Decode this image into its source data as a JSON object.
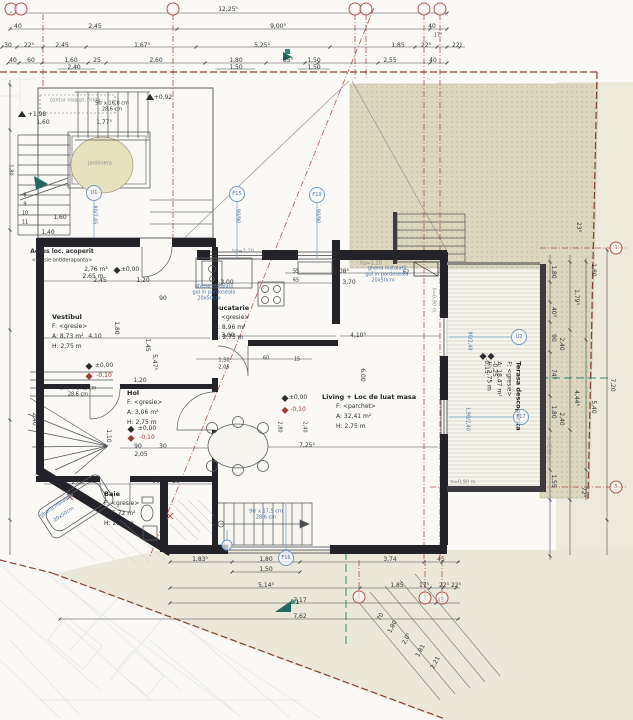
{
  "drawing": {
    "type": "architectural floor plan",
    "bubble_color": "#b5534b",
    "tag_color": "#4c74a8",
    "garden_color": "#dcd8bf",
    "paper_color": "#faf9f5",
    "pale_color": "#ebe8d9"
  },
  "rooms": [
    {
      "id": "vestibul",
      "name": "Vestibul",
      "f": "F:  <gresie>",
      "a": "A:  8,73 m²",
      "h": "H:  2,75 m",
      "x": 52,
      "y": 312,
      "rot": 0,
      "ind": 0
    },
    {
      "id": "bucatarie",
      "name": "Bucatarie",
      "f": "F:  <gresie>",
      "a": "A:  8,96 m²",
      "h": "H:  2,75 m",
      "x": 214,
      "y": 303,
      "rot": 0,
      "ind": 0
    },
    {
      "id": "living",
      "name": "Living + Loc de luat masa",
      "f": "F:  <parchet>",
      "a": "A:  32,41 m²",
      "h": "H:  2,75 m",
      "x": 322,
      "y": 392,
      "rot": 0,
      "ind": 14
    },
    {
      "id": "hol",
      "name": "Hol",
      "f": "F:  <gresie>",
      "a": "A:  3,06 m²",
      "h": "H:  2,75 m",
      "x": 127,
      "y": 388,
      "rot": 0,
      "ind": 0
    },
    {
      "id": "baie",
      "name": "Baie",
      "f": "F:  <gresie>",
      "a": "A:  5,72 m²",
      "h": "H:  2,75 m",
      "x": 104,
      "y": 489,
      "rot": 0,
      "ind": 0
    },
    {
      "id": "terasa",
      "name": "Terasa descoperita",
      "f": "F:  <gresie>",
      "a": "A:  18,47 m²",
      "h": "H:  2,75 m",
      "x": 504,
      "y": 396,
      "rot": 90,
      "ind": 0
    }
  ],
  "labels": [
    {
      "t": "12,25⁵",
      "x": 228,
      "y": 10
    },
    {
      "t": "40",
      "x": 18,
      "y": 27
    },
    {
      "t": "2,45",
      "x": 95,
      "y": 27
    },
    {
      "t": "9,00⁵",
      "x": 278,
      "y": 27
    },
    {
      "t": "40",
      "x": 432,
      "y": 27
    },
    {
      "t": "17⁵",
      "x": 438,
      "y": 36,
      "c": "t"
    },
    {
      "t": "30",
      "x": 8,
      "y": 46
    },
    {
      "t": "22⁵",
      "x": 29,
      "y": 46
    },
    {
      "t": "2,45",
      "x": 62,
      "y": 46
    },
    {
      "t": "1,67⁵",
      "x": 142,
      "y": 46
    },
    {
      "t": "5,25⁵",
      "x": 262,
      "y": 46
    },
    {
      "t": "1,85",
      "x": 398,
      "y": 46
    },
    {
      "t": "22⁵",
      "x": 426,
      "y": 46
    },
    {
      "t": "22⁵",
      "x": 457,
      "y": 46
    },
    {
      "t": "40",
      "x": 13,
      "y": 61
    },
    {
      "t": "60",
      "x": 31,
      "y": 61
    },
    {
      "t": "1,60",
      "x": 71,
      "y": 61
    },
    {
      "t": "25",
      "x": 97,
      "y": 61
    },
    {
      "t": "2,60",
      "x": 156,
      "y": 61
    },
    {
      "t": "1,80",
      "x": 236,
      "y": 61
    },
    {
      "t": "55⁵",
      "x": 288,
      "y": 61
    },
    {
      "t": "1,50",
      "x": 314,
      "y": 61
    },
    {
      "t": "2,55",
      "x": 390,
      "y": 61
    },
    {
      "t": "40",
      "x": 433,
      "y": 61
    },
    {
      "t": "2,40",
      "x": 74,
      "y": 68
    },
    {
      "t": "1,50",
      "x": 236,
      "y": 68
    },
    {
      "t": "1,50",
      "x": 314,
      "y": 68
    },
    {
      "t": "contur nisa pt. firida",
      "x": 75,
      "y": 101,
      "c": "t gray"
    },
    {
      "t": "+1,98",
      "x": 37,
      "y": 115
    },
    {
      "t": "5tr x 16,0 cm",
      "x": 112,
      "y": 104,
      "c": "t"
    },
    {
      "t": "28,6 cm",
      "x": 112,
      "y": 110,
      "c": "t"
    },
    {
      "t": "1,60",
      "x": 43,
      "y": 123
    },
    {
      "t": "1,77⁵",
      "x": 104,
      "y": 123
    },
    {
      "t": "+0,92",
      "x": 163,
      "y": 98
    },
    {
      "t": "jardiniera",
      "x": 100,
      "y": 164,
      "c": "t gray"
    },
    {
      "t": "1,60",
      "x": 60,
      "y": 218
    },
    {
      "t": "1,40",
      "x": 48,
      "y": 233
    },
    {
      "t": "80/2,05",
      "x": 94,
      "y": 215,
      "r": 90,
      "c": "blue t"
    },
    {
      "t": "8",
      "x": 25,
      "y": 196,
      "c": "t"
    },
    {
      "t": "9",
      "x": 25,
      "y": 205,
      "c": "t"
    },
    {
      "t": "10",
      "x": 25,
      "y": 214,
      "c": "t"
    },
    {
      "t": "11",
      "x": 25,
      "y": 223,
      "c": "t"
    },
    {
      "t": "Acces loc. acoperit",
      "x": 62,
      "y": 252,
      "c": "b",
      "n": "room-label-acces"
    },
    {
      "t": "<gresie antiderapanta>",
      "x": 62,
      "y": 261,
      "c": "t"
    },
    {
      "t": "2,76 m²",
      "x": 96,
      "y": 270
    },
    {
      "t": "2,65 m",
      "x": 93,
      "y": 277
    },
    {
      "t": "±0,00",
      "x": 130,
      "y": 270
    },
    {
      "t": "2,45",
      "x": 100,
      "y": 281
    },
    {
      "t": "1,20",
      "x": 143,
      "y": 281
    },
    {
      "t": "4,10",
      "x": 95,
      "y": 337
    },
    {
      "t": "90",
      "x": 163,
      "y": 299
    },
    {
      "t": "1,80",
      "x": 116,
      "y": 328,
      "r": 90
    },
    {
      "t": "1,45",
      "x": 147,
      "y": 345,
      "r": 90
    },
    {
      "t": "5,47⁵",
      "x": 154,
      "y": 362,
      "r": 90
    },
    {
      "t": "±0,00",
      "x": 104,
      "y": 366
    },
    {
      "t": "-0,10",
      "x": 104,
      "y": 376,
      "c": "red"
    },
    {
      "t": "3,00",
      "x": 227,
      "y": 283
    },
    {
      "t": "3,00",
      "x": 228,
      "y": 336
    },
    {
      "t": "1,50",
      "x": 224,
      "y": 361,
      "c": "t"
    },
    {
      "t": "2,05",
      "x": 224,
      "y": 368,
      "c": "t"
    },
    {
      "t": "60",
      "x": 266,
      "y": 359,
      "c": "t"
    },
    {
      "t": "15",
      "x": 297,
      "y": 360,
      "c": "t"
    },
    {
      "t": "55",
      "x": 296,
      "y": 272,
      "c": "t"
    },
    {
      "t": "65",
      "x": 296,
      "y": 281,
      "c": "t"
    },
    {
      "t": "3,08⁵",
      "x": 341,
      "y": 272
    },
    {
      "t": "3,70",
      "x": 349,
      "y": 283
    },
    {
      "t": "62",
      "x": 406,
      "y": 273,
      "c": "t"
    },
    {
      "t": "hp=1,20",
      "x": 243,
      "y": 252,
      "c": "t gray"
    },
    {
      "t": "hp=1,20",
      "x": 371,
      "y": 264,
      "c": "t gray"
    },
    {
      "t": "ghena instalatii",
      "x": 214,
      "y": 287,
      "c": "t blue"
    },
    {
      "t": "gol in pardoseala",
      "x": 214,
      "y": 293,
      "c": "t blue"
    },
    {
      "t": "20x50cm",
      "x": 209,
      "y": 299,
      "c": "t blue"
    },
    {
      "t": "ghena instalatii",
      "x": 387,
      "y": 269,
      "c": "t blue"
    },
    {
      "t": "gol in pardoseala",
      "x": 387,
      "y": 275,
      "c": "t blue"
    },
    {
      "t": "20x50cm",
      "x": 383,
      "y": 281,
      "c": "t blue"
    },
    {
      "t": "90/90",
      "x": 237,
      "y": 216,
      "r": 90,
      "c": "blue t"
    },
    {
      "t": "90/90",
      "x": 317,
      "y": 216,
      "r": 90,
      "c": "blue t"
    },
    {
      "t": "±0,00",
      "x": 298,
      "y": 398
    },
    {
      "t": "-0,10",
      "x": 298,
      "y": 410,
      "c": "red"
    },
    {
      "t": "7,25⁵",
      "x": 307,
      "y": 446
    },
    {
      "t": "4,10⁵",
      "x": 358,
      "y": 336
    },
    {
      "t": "6,00",
      "x": 362,
      "y": 375,
      "r": 90
    },
    {
      "t": "2,80",
      "x": 279,
      "y": 427,
      "r": 90,
      "c": "t"
    },
    {
      "t": "2,40",
      "x": 304,
      "y": 427,
      "r": 90,
      "c": "t"
    },
    {
      "t": "1,20",
      "x": 140,
      "y": 381
    },
    {
      "t": "90",
      "x": 138,
      "y": 447
    },
    {
      "t": "30",
      "x": 163,
      "y": 447
    },
    {
      "t": "2,05",
      "x": 141,
      "y": 455
    },
    {
      "t": "1,10",
      "x": 108,
      "y": 436,
      "r": 90
    },
    {
      "t": "2,60",
      "x": 78,
      "y": 483
    },
    {
      "t": "90",
      "x": 156,
      "y": 482
    },
    {
      "t": "30",
      "x": 176,
      "y": 482
    },
    {
      "t": "17tr x 17,1 cm",
      "x": 78,
      "y": 389,
      "c": "t"
    },
    {
      "t": "28,6 cm",
      "x": 78,
      "y": 395,
      "c": "t"
    },
    {
      "t": "±0,00",
      "x": 147,
      "y": 429
    },
    {
      "t": "-0,10",
      "x": 147,
      "y": 438,
      "c": "red"
    },
    {
      "t": "ghena instalatii",
      "x": 57,
      "y": 506,
      "r": -34,
      "c": "t blue"
    },
    {
      "t": "20x50cm",
      "x": 64,
      "y": 515,
      "r": -34,
      "c": "t blue"
    },
    {
      "t": "-0,15",
      "x": 486,
      "y": 366,
      "r": 90
    },
    {
      "t": "-0,25",
      "x": 494,
      "y": 369,
      "r": 90
    },
    {
      "t": "90/2,40",
      "x": 469,
      "y": 341,
      "r": 90,
      "c": "blue t"
    },
    {
      "t": "1,90/2,40",
      "x": 467,
      "y": 419,
      "r": 90,
      "c": "blue t"
    },
    {
      "t": "h=0,90 m",
      "x": 433,
      "y": 300,
      "r": 90,
      "c": "t gray"
    },
    {
      "t": "h=0,90 m",
      "x": 548,
      "y": 449,
      "r": 90,
      "c": "t gray"
    },
    {
      "t": "h=0,90 m",
      "x": 463,
      "y": 483,
      "c": "t gray"
    },
    {
      "t": "23⁵",
      "x": 578,
      "y": 227,
      "r": 90
    },
    {
      "t": "1,80",
      "x": 553,
      "y": 272,
      "r": 90
    },
    {
      "t": "40⁵",
      "x": 553,
      "y": 312,
      "r": 90
    },
    {
      "t": "90",
      "x": 553,
      "y": 338,
      "r": 90
    },
    {
      "t": "74⁵",
      "x": 553,
      "y": 374,
      "r": 90
    },
    {
      "t": "1,80",
      "x": 553,
      "y": 412,
      "r": 90
    },
    {
      "t": "1,55",
      "x": 553,
      "y": 481,
      "r": 90
    },
    {
      "t": "2,40",
      "x": 561,
      "y": 344,
      "r": 90
    },
    {
      "t": "2,40",
      "x": 561,
      "y": 419,
      "r": 90
    },
    {
      "t": "1,79⁵",
      "x": 576,
      "y": 297,
      "r": 90
    },
    {
      "t": "4,44⁵",
      "x": 576,
      "y": 398,
      "r": 90
    },
    {
      "t": "1,80",
      "x": 593,
      "y": 270,
      "r": 90
    },
    {
      "t": "5,40",
      "x": 593,
      "y": 407,
      "r": 90
    },
    {
      "t": "7,20",
      "x": 612,
      "y": 385,
      "r": 90
    },
    {
      "t": "72⁵",
      "x": 583,
      "y": 492,
      "r": 90
    },
    {
      "t": "2,40",
      "x": 34,
      "y": 419,
      "r": 90
    },
    {
      "t": "1,80",
      "x": 10,
      "y": 170,
      "r": 90,
      "c": "t"
    },
    {
      "t": "1,83⁵",
      "x": 200,
      "y": 560
    },
    {
      "t": "1,80",
      "x": 266,
      "y": 560
    },
    {
      "t": "3,74",
      "x": 390,
      "y": 560
    },
    {
      "t": "45",
      "x": 441,
      "y": 560
    },
    {
      "t": "1,50",
      "x": 266,
      "y": 570
    },
    {
      "t": "5,14⁵",
      "x": 266,
      "y": 586
    },
    {
      "t": "1,85",
      "x": 397,
      "y": 586
    },
    {
      "t": "17⁵",
      "x": 424,
      "y": 586
    },
    {
      "t": "22⁵",
      "x": 444,
      "y": 586
    },
    {
      "t": "22⁵",
      "x": 456,
      "y": 586
    },
    {
      "t": "7,17",
      "x": 300,
      "y": 601
    },
    {
      "t": "45",
      "x": 441,
      "y": 601
    },
    {
      "t": "7,62",
      "x": 300,
      "y": 617
    },
    {
      "t": "9tr x 17,5 cm",
      "x": 266,
      "y": 512,
      "c": "t blue"
    },
    {
      "t": "28,6 cm",
      "x": 266,
      "y": 518,
      "c": "t blue"
    },
    {
      "t": "B1",
      "x": 295,
      "y": 603,
      "c": "teal",
      "n": "section-label"
    },
    {
      "t": "70",
      "x": 381,
      "y": 617,
      "r": -62
    },
    {
      "t": "1,80",
      "x": 393,
      "y": 627,
      "r": -62
    },
    {
      "t": "2,0⁵",
      "x": 407,
      "y": 639,
      "r": -62
    },
    {
      "t": "1,81",
      "x": 421,
      "y": 651,
      "r": -62
    },
    {
      "t": "2,21",
      "x": 436,
      "y": 663,
      "r": -62
    }
  ],
  "grid_bubbles": [
    {
      "x": 11,
      "y": 9,
      "t": ""
    },
    {
      "x": 21,
      "y": 9,
      "t": ""
    },
    {
      "x": 173,
      "y": 9,
      "t": ""
    },
    {
      "x": 355,
      "y": 9,
      "t": ""
    },
    {
      "x": 366,
      "y": 9,
      "t": ""
    },
    {
      "x": 424,
      "y": 9,
      "t": ""
    },
    {
      "x": 440,
      "y": 9,
      "t": ""
    },
    {
      "x": 359,
      "y": 597,
      "t": ""
    },
    {
      "x": 425,
      "y": 598,
      "t": ""
    },
    {
      "x": 442,
      "y": 598,
      "t": ""
    },
    {
      "x": 616,
      "y": 248,
      "t": "1"
    },
    {
      "x": 616,
      "y": 487,
      "t": "5"
    }
  ],
  "window_tags": [
    {
      "x": 237,
      "y": 194,
      "t": "F15"
    },
    {
      "x": 317,
      "y": 195,
      "t": "F19"
    },
    {
      "x": 286,
      "y": 558,
      "t": "F16"
    },
    {
      "x": 521,
      "y": 417,
      "t": "F17"
    },
    {
      "x": 519,
      "y": 337,
      "t": "U2"
    },
    {
      "x": 94,
      "y": 193,
      "t": "U1"
    },
    {
      "x": 227,
      "y": 545,
      "t": "",
      "sm": 1
    }
  ],
  "level_markers": [
    {
      "x": 89,
      "y": 366
    },
    {
      "x": 89,
      "y": 376,
      "red": 1
    },
    {
      "x": 131,
      "y": 429
    },
    {
      "x": 131,
      "y": 438,
      "red": 1
    },
    {
      "x": 285,
      "y": 398
    },
    {
      "x": 285,
      "y": 410,
      "red": 1
    },
    {
      "x": 117,
      "y": 270
    },
    {
      "x": 483,
      "y": 356
    },
    {
      "x": 491,
      "y": 356
    },
    {
      "x": 22,
      "y": 117,
      "tri": 1
    },
    {
      "x": 150,
      "y": 100,
      "tri": 1
    }
  ]
}
